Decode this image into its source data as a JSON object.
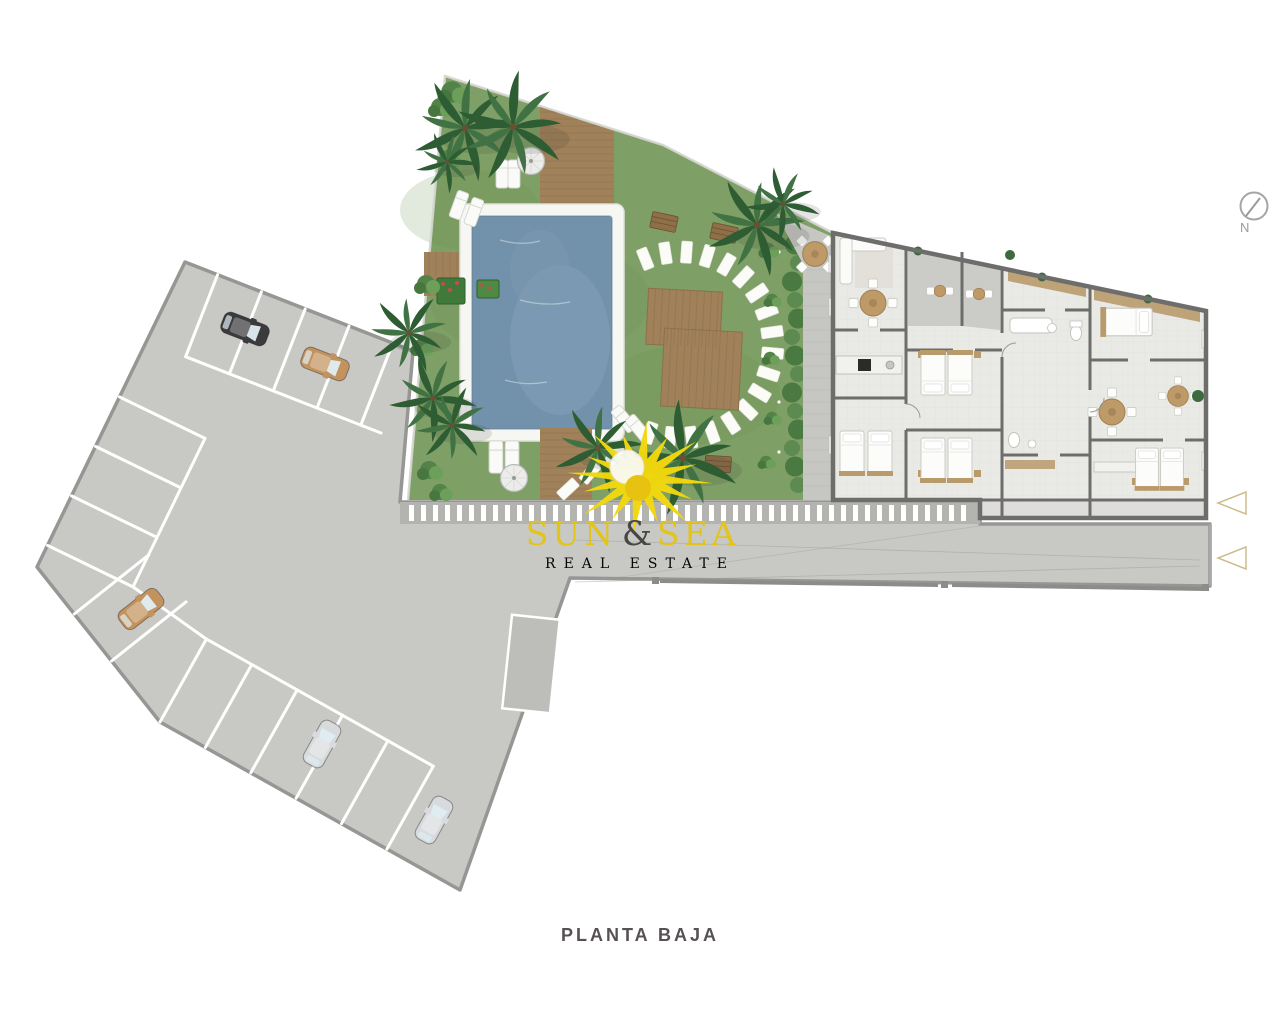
{
  "plan": {
    "title": "PLANTA BAJA"
  },
  "compass": {
    "label": "N"
  },
  "logo": {
    "word1": "SUN",
    "ampersand": "&",
    "word2": "SEA",
    "tagline": "REAL ESTATE"
  },
  "counts": {
    "parked_cars": 5,
    "entrance_arrows": 2,
    "parasols": 2
  },
  "cars": [
    {
      "id": "car-1",
      "color_key": "car_black"
    },
    {
      "id": "car-2",
      "color_key": "car_tan"
    },
    {
      "id": "car-3",
      "color_key": "car_tan"
    },
    {
      "id": "car-4",
      "color_key": "car_silver"
    },
    {
      "id": "car-5",
      "color_key": "car_silver"
    }
  ],
  "colors": {
    "paving": "#c8c8c5",
    "paving_edge": "#969694",
    "band": "#b3b3b0",
    "stripe": "#ffffff",
    "lawn": "#7e9f65",
    "pool_water": "#7291ab",
    "pool_deck": "#f6f6f2",
    "wood": "#a0815a",
    "wood_dark": "#8d6f4a",
    "building_floor": "#e9e9e6",
    "wall": "#6d6d6b",
    "terrace": "#c6c6c2",
    "hedge": "#4a7a42",
    "palm": "#2e5c33",
    "palm_light": "#417244",
    "sun": "#f2d80e",
    "logo_yellow": "#e4c414",
    "logo_dark": "#454241",
    "arrow": "#cdbd8d",
    "car_black": "#3b3b3d",
    "car_tan": "#c2935f",
    "car_silver": "#d8dbdd",
    "title_color": "#575151",
    "compass_color": "#9b9b99"
  }
}
